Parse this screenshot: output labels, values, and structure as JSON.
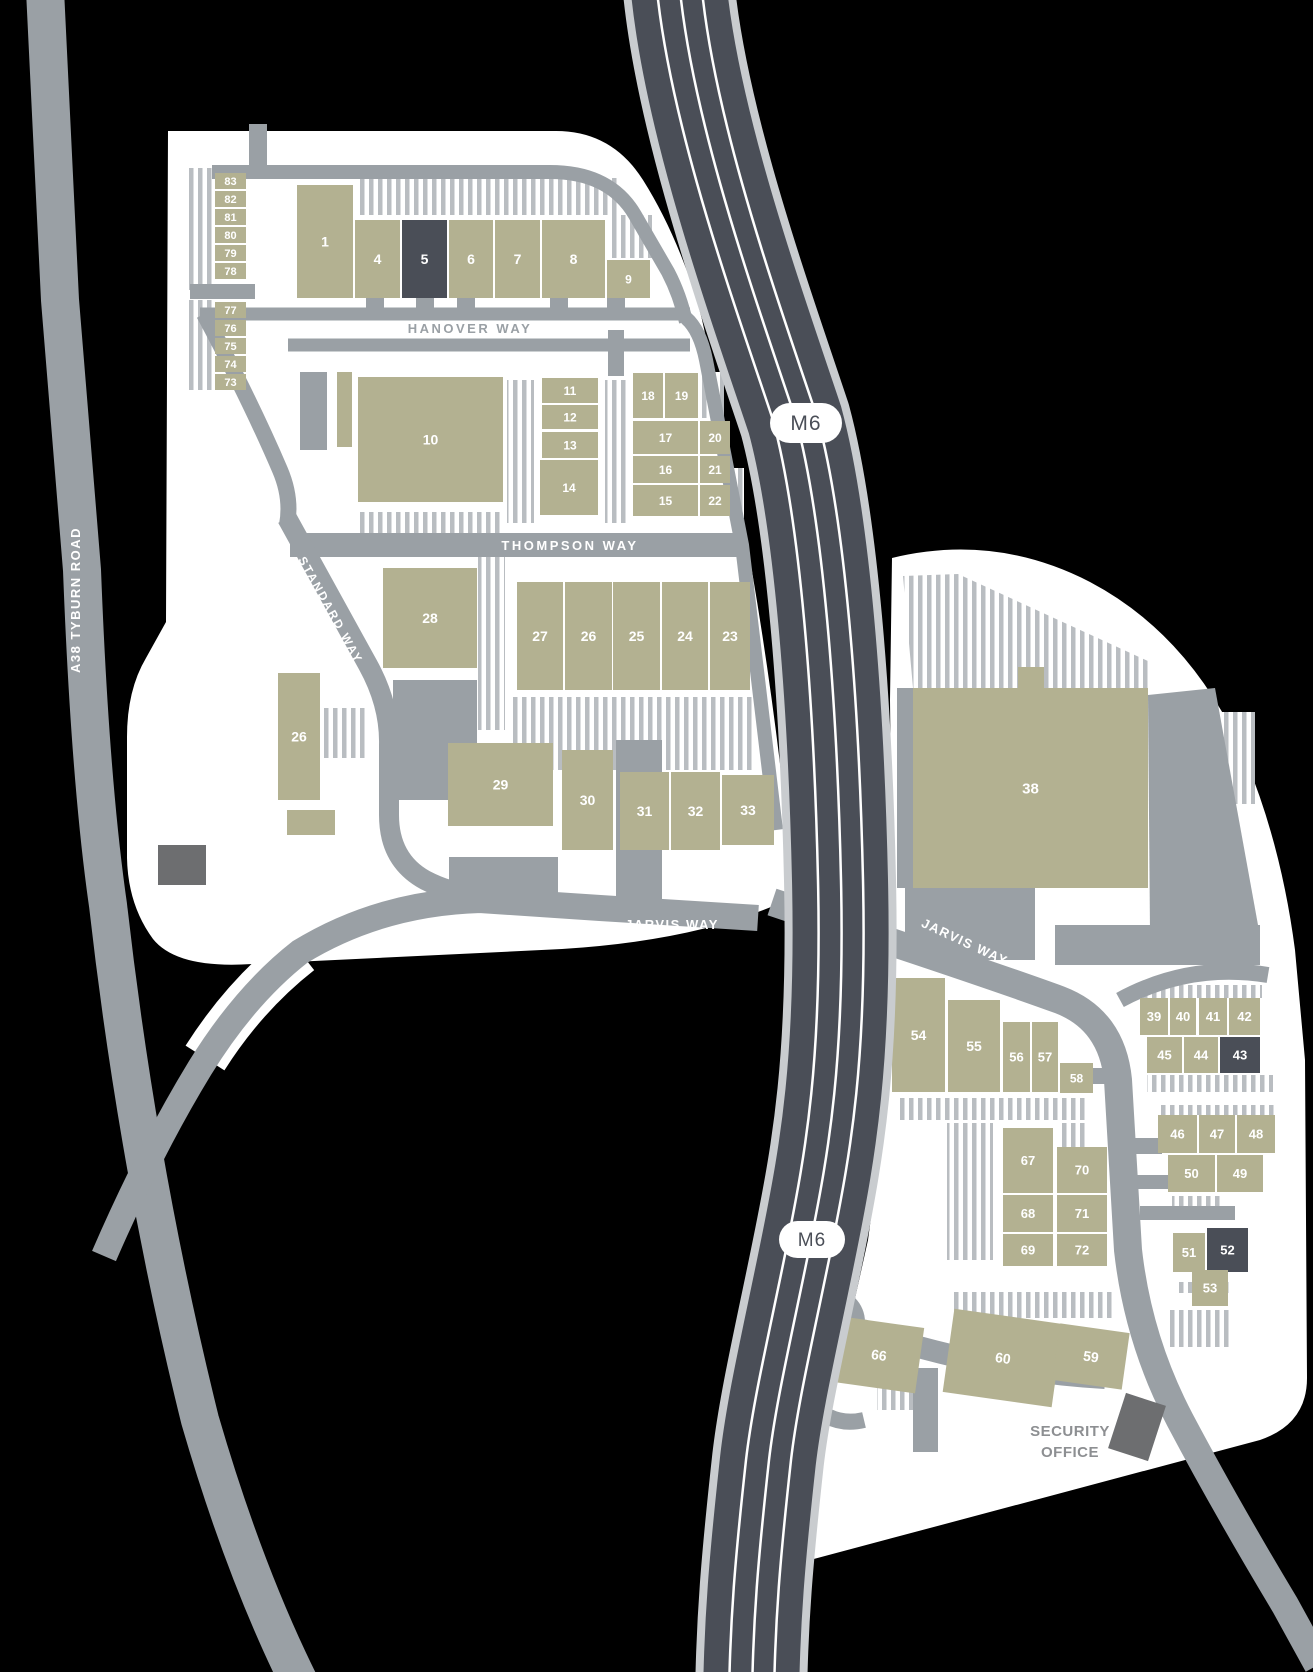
{
  "map": {
    "colors": {
      "background": "#000000",
      "estate": "#ffffff",
      "road": "#9aa0a5",
      "hatch": "#b9bdc1",
      "building": "#b3b191",
      "building_dark": "#4a4e57",
      "building_gray": "#6d6e70",
      "motorway": "#4a4e57",
      "motorway_edge": "#c9cccf",
      "lane_line": "#ffffff",
      "label_gray": "#9aa0a5",
      "security_text": "#8d8f92",
      "number_text": "#ffffff"
    },
    "labels": {
      "motorway_north": "M6",
      "motorway_south": "M6",
      "a38": "A38 TYBURN ROAD",
      "hanover": "HANOVER WAY",
      "thompson": "THOMPSON WAY",
      "standard": "STANDARD WAY",
      "jarvis_west": "JARVIS WAY",
      "jarvis_east": "JARVIS WAY",
      "security_line1": "SECURITY",
      "security_line2": "OFFICE"
    },
    "buildings": [
      {
        "n": "83",
        "x": 215,
        "y": 173,
        "w": 31,
        "h": 16,
        "f": 11
      },
      {
        "n": "82",
        "x": 215,
        "y": 191,
        "w": 31,
        "h": 16,
        "f": 11
      },
      {
        "n": "81",
        "x": 215,
        "y": 209,
        "w": 31,
        "h": 16,
        "f": 11
      },
      {
        "n": "80",
        "x": 215,
        "y": 227,
        "w": 31,
        "h": 16,
        "f": 11
      },
      {
        "n": "79",
        "x": 215,
        "y": 245,
        "w": 31,
        "h": 16,
        "f": 11
      },
      {
        "n": "78",
        "x": 215,
        "y": 263,
        "w": 31,
        "h": 16,
        "f": 11
      },
      {
        "n": "77",
        "x": 215,
        "y": 302,
        "w": 31,
        "h": 16,
        "f": 11
      },
      {
        "n": "76",
        "x": 215,
        "y": 320,
        "w": 31,
        "h": 16,
        "f": 11
      },
      {
        "n": "75",
        "x": 215,
        "y": 338,
        "w": 31,
        "h": 16,
        "f": 11
      },
      {
        "n": "74",
        "x": 215,
        "y": 356,
        "w": 31,
        "h": 16,
        "f": 11
      },
      {
        "n": "73",
        "x": 215,
        "y": 374,
        "w": 31,
        "h": 16,
        "f": 11
      },
      {
        "n": "1",
        "x": 297,
        "y": 185,
        "w": 56,
        "h": 113,
        "f": 14
      },
      {
        "n": "4",
        "x": 355,
        "y": 220,
        "w": 45,
        "h": 78,
        "f": 14
      },
      {
        "n": "5",
        "x": 402,
        "y": 220,
        "w": 45,
        "h": 78,
        "f": 14,
        "v": "d"
      },
      {
        "n": "6",
        "x": 449,
        "y": 220,
        "w": 44,
        "h": 78,
        "f": 14
      },
      {
        "n": "7",
        "x": 495,
        "y": 220,
        "w": 45,
        "h": 78,
        "f": 14
      },
      {
        "n": "8",
        "x": 542,
        "y": 220,
        "w": 63,
        "h": 78,
        "f": 14
      },
      {
        "n": "9",
        "x": 607,
        "y": 260,
        "w": 43,
        "h": 38,
        "f": 12
      },
      {
        "n": "10",
        "x": 358,
        "y": 377,
        "w": 145,
        "h": 125,
        "f": 14
      },
      {
        "n": "11",
        "x": 542,
        "y": 378,
        "w": 56,
        "h": 25,
        "f": 12
      },
      {
        "n": "12",
        "x": 542,
        "y": 405,
        "w": 56,
        "h": 24,
        "f": 12
      },
      {
        "n": "13",
        "x": 542,
        "y": 432,
        "w": 56,
        "h": 26,
        "f": 12
      },
      {
        "n": "14",
        "x": 540,
        "y": 460,
        "w": 58,
        "h": 55,
        "f": 12
      },
      {
        "n": "18",
        "x": 633,
        "y": 373,
        "w": 30,
        "h": 45,
        "f": 12
      },
      {
        "n": "19",
        "x": 665,
        "y": 373,
        "w": 33,
        "h": 45,
        "f": 12
      },
      {
        "n": "17",
        "x": 633,
        "y": 421,
        "w": 65,
        "h": 33,
        "f": 12
      },
      {
        "n": "20",
        "x": 700,
        "y": 421,
        "w": 30,
        "h": 33,
        "f": 12
      },
      {
        "n": "16",
        "x": 633,
        "y": 456,
        "w": 65,
        "h": 27,
        "f": 12
      },
      {
        "n": "21",
        "x": 700,
        "y": 456,
        "w": 30,
        "h": 27,
        "f": 12
      },
      {
        "n": "15",
        "x": 633,
        "y": 485,
        "w": 65,
        "h": 31,
        "f": 12
      },
      {
        "n": "22",
        "x": 700,
        "y": 485,
        "w": 30,
        "h": 31,
        "f": 12
      },
      {
        "n": "28",
        "x": 383,
        "y": 568,
        "w": 94,
        "h": 100,
        "f": 14
      },
      {
        "n": "27",
        "x": 517,
        "y": 582,
        "w": 46,
        "h": 108,
        "f": 14
      },
      {
        "n": "26",
        "x": 565,
        "y": 582,
        "w": 47,
        "h": 108,
        "f": 14
      },
      {
        "n": "25",
        "x": 613,
        "y": 582,
        "w": 47,
        "h": 108,
        "f": 14
      },
      {
        "n": "24",
        "x": 662,
        "y": 582,
        "w": 46,
        "h": 108,
        "f": 14
      },
      {
        "n": "23",
        "x": 710,
        "y": 582,
        "w": 40,
        "h": 108,
        "f": 14
      },
      {
        "n": "26",
        "x": 278,
        "y": 673,
        "w": 42,
        "h": 127,
        "f": 14
      },
      {
        "n": "29",
        "x": 448,
        "y": 743,
        "w": 105,
        "h": 83,
        "f": 14
      },
      {
        "n": "30",
        "x": 562,
        "y": 750,
        "w": 51,
        "h": 100,
        "f": 14
      },
      {
        "n": "31",
        "x": 620,
        "y": 772,
        "w": 49,
        "h": 78,
        "f": 14
      },
      {
        "n": "32",
        "x": 671,
        "y": 772,
        "w": 49,
        "h": 78,
        "f": 14
      },
      {
        "n": "33",
        "x": 722,
        "y": 775,
        "w": 52,
        "h": 70,
        "f": 14
      },
      {
        "n": "38",
        "x": 913,
        "y": 688,
        "w": 235,
        "h": 200,
        "f": 15
      },
      {
        "n": "54",
        "x": 892,
        "y": 978,
        "w": 53,
        "h": 114,
        "f": 14
      },
      {
        "n": "55",
        "x": 948,
        "y": 1000,
        "w": 52,
        "h": 92,
        "f": 14
      },
      {
        "n": "56",
        "x": 1003,
        "y": 1022,
        "w": 27,
        "h": 70,
        "f": 13
      },
      {
        "n": "57",
        "x": 1032,
        "y": 1022,
        "w": 26,
        "h": 70,
        "f": 13
      },
      {
        "n": "58",
        "x": 1060,
        "y": 1063,
        "w": 33,
        "h": 30,
        "f": 12
      },
      {
        "n": "39",
        "x": 1140,
        "y": 998,
        "w": 28,
        "h": 37,
        "f": 13
      },
      {
        "n": "40",
        "x": 1170,
        "y": 998,
        "w": 26,
        "h": 37,
        "f": 13
      },
      {
        "n": "41",
        "x": 1199,
        "y": 998,
        "w": 28,
        "h": 37,
        "f": 13
      },
      {
        "n": "42",
        "x": 1229,
        "y": 998,
        "w": 31,
        "h": 37,
        "f": 13
      },
      {
        "n": "45",
        "x": 1147,
        "y": 1037,
        "w": 35,
        "h": 36,
        "f": 13
      },
      {
        "n": "44",
        "x": 1184,
        "y": 1037,
        "w": 34,
        "h": 36,
        "f": 13
      },
      {
        "n": "43",
        "x": 1220,
        "y": 1037,
        "w": 40,
        "h": 36,
        "f": 13,
        "v": "d"
      },
      {
        "n": "46",
        "x": 1158,
        "y": 1115,
        "w": 39,
        "h": 38,
        "f": 13
      },
      {
        "n": "47",
        "x": 1199,
        "y": 1115,
        "w": 36,
        "h": 38,
        "f": 13
      },
      {
        "n": "48",
        "x": 1237,
        "y": 1115,
        "w": 38,
        "h": 38,
        "f": 13
      },
      {
        "n": "50",
        "x": 1168,
        "y": 1155,
        "w": 47,
        "h": 37,
        "f": 13
      },
      {
        "n": "49",
        "x": 1217,
        "y": 1155,
        "w": 46,
        "h": 37,
        "f": 13
      },
      {
        "n": "67",
        "x": 1003,
        "y": 1128,
        "w": 50,
        "h": 65,
        "f": 13
      },
      {
        "n": "70",
        "x": 1057,
        "y": 1147,
        "w": 50,
        "h": 46,
        "f": 13
      },
      {
        "n": "68",
        "x": 1003,
        "y": 1195,
        "w": 50,
        "h": 37,
        "f": 13
      },
      {
        "n": "71",
        "x": 1057,
        "y": 1195,
        "w": 50,
        "h": 37,
        "f": 13
      },
      {
        "n": "69",
        "x": 1003,
        "y": 1234,
        "w": 50,
        "h": 32,
        "f": 13
      },
      {
        "n": "72",
        "x": 1057,
        "y": 1234,
        "w": 50,
        "h": 32,
        "f": 13
      },
      {
        "n": "51",
        "x": 1173,
        "y": 1233,
        "w": 32,
        "h": 39,
        "f": 13
      },
      {
        "n": "52",
        "x": 1207,
        "y": 1228,
        "w": 41,
        "h": 44,
        "f": 13,
        "v": "d"
      },
      {
        "n": "53",
        "x": 1192,
        "y": 1270,
        "w": 36,
        "h": 36,
        "f": 13
      },
      {
        "n": "66",
        "x": 838,
        "y": 1322,
        "w": 82,
        "h": 66,
        "f": 14,
        "r": 8
      },
      {
        "n": "60",
        "x": 948,
        "y": 1316,
        "w": 110,
        "h": 84,
        "f": 14,
        "r": 8
      },
      {
        "n": "59",
        "x": 1056,
        "y": 1328,
        "w": 70,
        "h": 57,
        "f": 14,
        "r": 8
      },
      {
        "n": "",
        "x": 337,
        "y": 372,
        "w": 15,
        "h": 75,
        "f": 0
      },
      {
        "n": "",
        "x": 287,
        "y": 810,
        "w": 48,
        "h": 25,
        "f": 0
      },
      {
        "n": "",
        "x": 1018,
        "y": 667,
        "w": 26,
        "h": 22,
        "f": 0
      }
    ]
  }
}
